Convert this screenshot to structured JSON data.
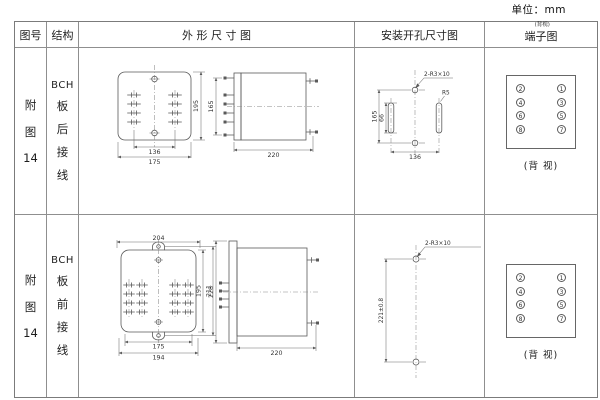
{
  "unit_label": "单位：mm",
  "header": {
    "fig_no": "图号",
    "structure": "结构",
    "outline": "外 形 尺 寸 图",
    "mounting": "安装开孔尺寸图",
    "terminal": "端子图",
    "terminal_note": "(背视)"
  },
  "rows": [
    {
      "fig_lines": [
        "附",
        "图",
        "14"
      ],
      "structure_lines": [
        "BCH",
        "板",
        "后",
        "接",
        "线"
      ],
      "outline": {
        "front_height": "195",
        "hole_pitch": "136",
        "front_width": "175",
        "terminal_span": "165",
        "depth": "220"
      },
      "mounting": {
        "hole_span": "165",
        "slot_length": "66",
        "slot_pitch": "136",
        "holes_label": "2-R3×10",
        "radius_label": "R5"
      },
      "terminal": {
        "left": [
          "2",
          "4",
          "6",
          "8"
        ],
        "right": [
          "1",
          "3",
          "5",
          "7"
        ],
        "caption": "(背 视)"
      }
    },
    {
      "fig_lines": [
        "附",
        "图",
        "14"
      ],
      "structure_lines": [
        "BCH",
        "板",
        "前",
        "接",
        "线"
      ],
      "outline": {
        "top_width": "204",
        "inner_height": "195",
        "outer_height": "211",
        "inner_width": "175",
        "outer_width": "194",
        "panel_height": "228",
        "depth": "220"
      },
      "mounting": {
        "hole_pitch": "221±0.8",
        "holes_label": "2-R3×10"
      },
      "terminal": {
        "left": [
          "2",
          "4",
          "6",
          "8"
        ],
        "right": [
          "1",
          "3",
          "5",
          "7"
        ],
        "caption": "(背 视)"
      }
    }
  ]
}
